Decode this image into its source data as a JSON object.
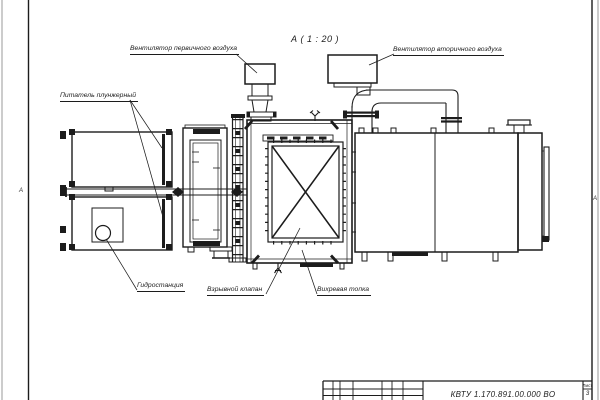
{
  "sheet": {
    "view_title": "А ( 1 : 20 )",
    "zone_marker_left": "А",
    "zone_marker_right": "А"
  },
  "callouts": {
    "primary_fan": "Вентилятор первичного воздуха",
    "secondary_fan": "Вентилятор вторичного воздуха",
    "feeder": "Питатель плунжерный",
    "hydro_station": "Гидростанция",
    "explosion_valve": "Взрывной клапан",
    "vortex_furnace": "Вихревая топка"
  },
  "title_block": {
    "designation": "КВТУ 1.170.891.00.000 ВО",
    "sheet_label": "Лист",
    "sheet_number": "3"
  },
  "colors": {
    "line": "#1c1c1c",
    "background": "#ffffff"
  }
}
